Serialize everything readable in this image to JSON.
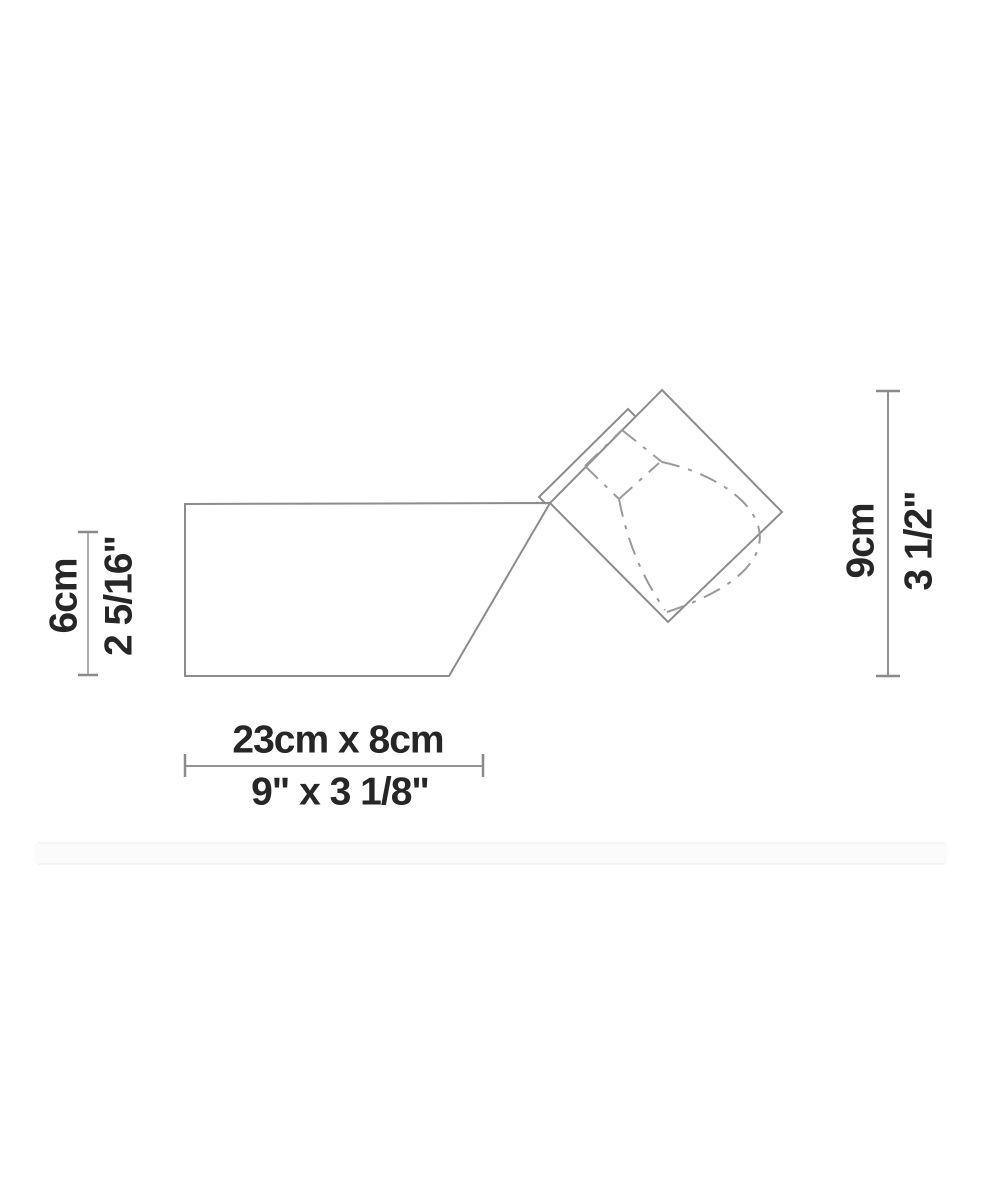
{
  "diagram": {
    "dimensions": {
      "body_height": {
        "metric": "6cm",
        "imperial": "2 5/16\""
      },
      "overall_height": {
        "metric": "9cm",
        "imperial": "3 1/2\""
      },
      "footprint": {
        "metric": "23cm x 8cm",
        "imperial": "9\" x 3 1/8\""
      }
    },
    "colors": {
      "outline": "#8c8c8c",
      "hidden_line": "#9a9a9a",
      "dimension_line": "#929292",
      "text": "#262626",
      "background": "#ffffff"
    }
  }
}
